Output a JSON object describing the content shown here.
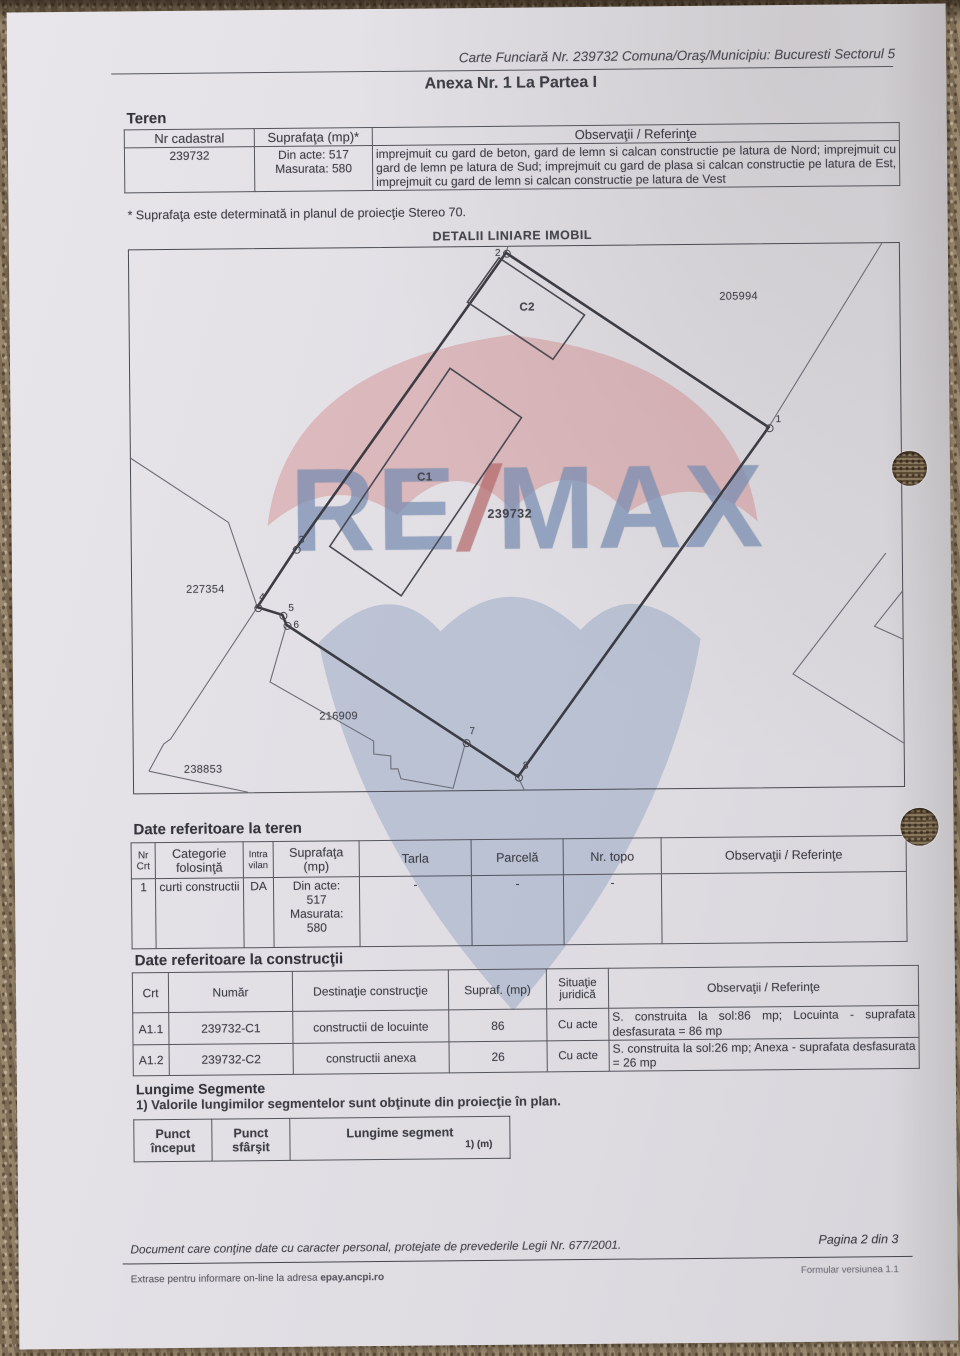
{
  "document": {
    "header_reference": "Carte Funciară Nr. 239732 Comuna/Oraş/Municipiu: Bucuresti Sectorul 5",
    "title": "Anexa Nr. 1 La Partea I"
  },
  "teren": {
    "heading": "Teren",
    "headers": [
      "Nr cadastral",
      "Suprafaţa (mp)*",
      "Observaţii / Referinţe"
    ],
    "row": {
      "nr_cadastral": "239732",
      "suprafata": "Din acte: 517\nMasurata: 580",
      "observatii": "imprejmuit cu gard de beton, gard de lemn si calcan constructie pe latura de Nord; imprejmuit cu gard de lemn pe latura de Sud; imprejmuit cu gard de plasa si calcan constructie pe latura de Est, imprejmuit cu gard de lemn si calcan constructie pe latura de Vest"
    },
    "footnote": "* Suprafaţa este determinată in planul de proiecţie Stereo 70."
  },
  "map": {
    "title": "DETALII LINIARE IMOBIL",
    "watermark_text_re": "RE",
    "watermark_text_slash": "/",
    "watermark_text_max": "MAX",
    "points": [
      {
        "n": "1",
        "x": 638,
        "y": 183,
        "lx": 645,
        "ly": 170
      },
      {
        "n": "2",
        "x": 377,
        "y": 6,
        "lx": 366,
        "ly": 1
      },
      {
        "n": "3",
        "x": 164,
        "y": 300,
        "lx": 167,
        "ly": 286
      },
      {
        "n": "4",
        "x": 125,
        "y": 358,
        "lx": 127,
        "ly": 343
      },
      {
        "n": "5",
        "x": 150,
        "y": 366,
        "lx": 156,
        "ly": 354
      },
      {
        "n": "6",
        "x": 154,
        "y": 376,
        "lx": 161,
        "ly": 371
      },
      {
        "n": "7",
        "x": 332,
        "y": 495,
        "lx": 336,
        "ly": 479
      },
      {
        "n": "8",
        "x": 384,
        "y": 530,
        "lx": 389,
        "ly": 514
      }
    ],
    "labels": [
      {
        "t": "C2",
        "x": 390,
        "y": 55,
        "cls": "bld"
      },
      {
        "t": "C1",
        "x": 286,
        "y": 224,
        "cls": "bld"
      },
      {
        "t": "239732",
        "x": 356,
        "y": 260,
        "cls": "big"
      },
      {
        "t": "205994",
        "x": 590,
        "y": 46,
        "cls": ""
      },
      {
        "t": "227354",
        "x": 54,
        "y": 334,
        "cls": ""
      },
      {
        "t": "216909",
        "x": 186,
        "y": 462,
        "cls": ""
      },
      {
        "t": "238853",
        "x": 50,
        "y": 514,
        "cls": ""
      }
    ]
  },
  "teren_date": {
    "heading": "Date referitoare la teren",
    "headers": [
      "Nr Crt",
      "Categorie folosinţă",
      "Intra vilan",
      "Suprafaţa (mp)",
      "Tarla",
      "Parcelă",
      "Nr. topo",
      "Observaţii / Referinţe"
    ],
    "row": [
      "1",
      "curti constructii",
      "DA",
      "Din acte:\n517\nMasurata:\n580",
      "-",
      "-",
      "-",
      ""
    ]
  },
  "constructii": {
    "heading": "Date referitoare la construcţii",
    "headers": [
      "Crt",
      "Număr",
      "Destinaţie construcţie",
      "Supraf. (mp)",
      "Situaţie juridică",
      "Observaţii / Referinţe"
    ],
    "rows": [
      [
        "A1.1",
        "239732-C1",
        "constructii de locuinte",
        "86",
        "Cu acte",
        "S. construita la sol:86 mp;  Locuinta  -  suprafata desfasurata = 86 mp"
      ],
      [
        "A1.2",
        "239732-C2",
        "constructii anexa",
        "26",
        "Cu acte",
        "S. construita la sol:26 mp; Anexa  -  suprafata desfasurata = 26 mp"
      ]
    ]
  },
  "segmente": {
    "heading": "Lungime Segmente",
    "note": "1) Valorile lungimilor segmentelor sunt obţinute din proiecţie în plan.",
    "headers": [
      "Punct început",
      "Punct sfârşit",
      "Lungime segment"
    ],
    "unit_line": "1) (m)"
  },
  "footer": {
    "privacy": "Document care conţine date cu caracter personal, protejate de prevederile Legii Nr. 677/2001.",
    "page": "Pagina 2 din 3",
    "extras_prefix": "Extrase pentru informare on-line la adresa ",
    "extras_bold": "epay.ancpi.ro",
    "version": "Formular versiunea 1.1"
  }
}
